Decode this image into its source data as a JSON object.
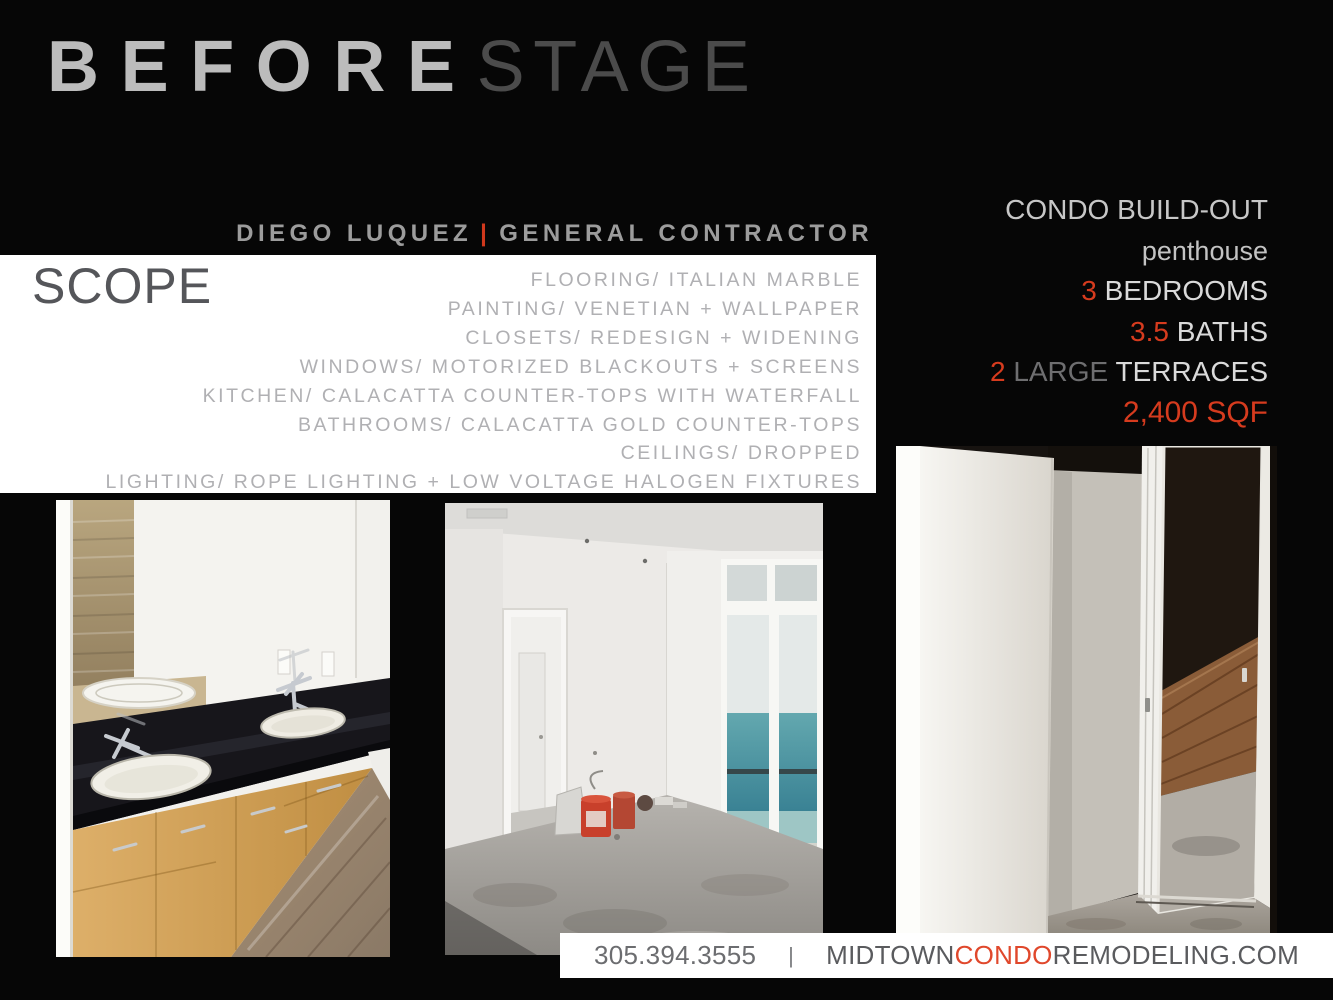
{
  "title": {
    "primary": "BEFORE",
    "secondary": "STAGE"
  },
  "byline": {
    "name": "DIEGO LUQUEZ",
    "separator": "|",
    "role": "GENERAL CONTRACTOR"
  },
  "scope": {
    "heading": "SCOPE",
    "items": [
      "FLOORING/ ITALIAN MARBLE",
      "PAINTING/ VENETIAN + WALLPAPER",
      "CLOSETS/ REDESIGN + WIDENING",
      "WINDOWS/ MOTORIZED BLACKOUTS + SCREENS",
      "KITCHEN/ CALACATTA COUNTER-TOPS WITH WATERFALL",
      "BATHROOMS/ CALACATTA GOLD COUNTER-TOPS",
      "CEILINGS/ DROPPED",
      "LIGHTING/ ROPE LIGHTING + LOW VOLTAGE HALOGEN FIXTURES"
    ]
  },
  "details": {
    "heading": "CONDO BUILD-OUT",
    "subheading": "penthouse",
    "bedrooms": {
      "value": "3",
      "label": "BEDROOMS"
    },
    "baths": {
      "value": "3.5",
      "label": "BATHS"
    },
    "terraces": {
      "value": "2",
      "qualifier": "LARGE",
      "label": "TERRACES"
    },
    "area": "2,400 SQF"
  },
  "footer": {
    "phone": "305.394.3555",
    "separator": "|",
    "website": {
      "prefix": "MIDTOWN",
      "highlight": "CONDO",
      "suffix": "REMODELING.COM"
    }
  },
  "photos": [
    {
      "id": "bathroom-vanity",
      "description": "double-sink vanity, black granite top, maple cabinets"
    },
    {
      "id": "empty-living-room",
      "description": "unfinished room with ocean-view window and paint buckets"
    },
    {
      "id": "closet-mirror-doors",
      "description": "white column and mirrored sliding closet doors"
    }
  ],
  "colors": {
    "background": "#060606",
    "accent_red": "#d63b1e",
    "footer_red": "#e0482c",
    "title_gray": "#bcbcbc",
    "muted_gray": "#9c9c9c",
    "scope_text_gray": "#b0b0b3"
  }
}
